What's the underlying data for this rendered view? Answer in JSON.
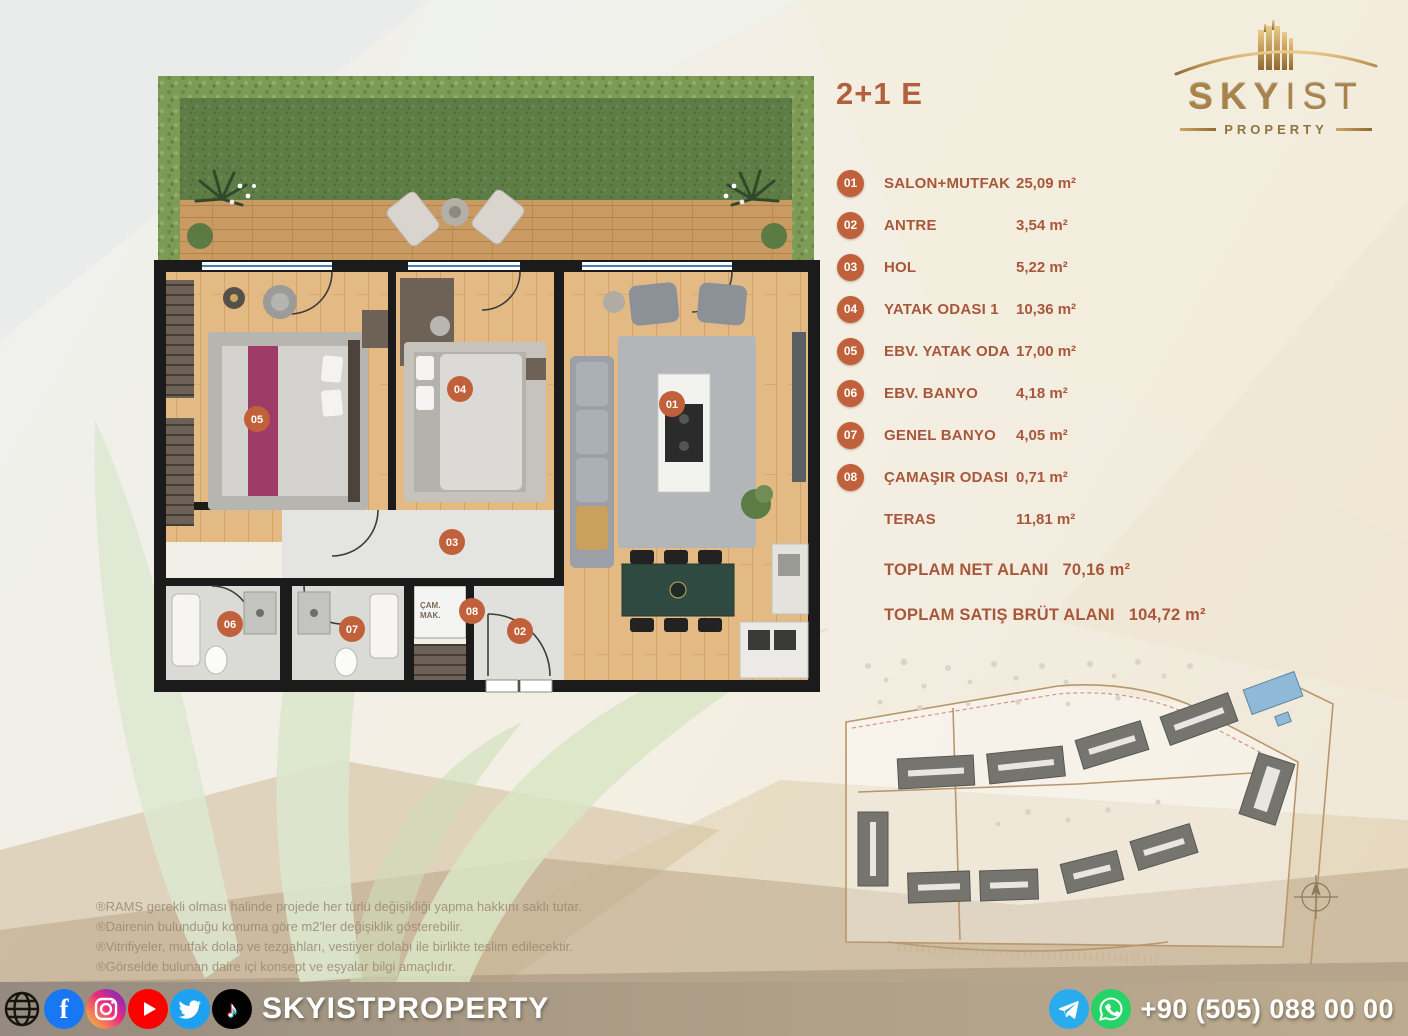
{
  "title": "2+1 E",
  "rooms": [
    {
      "num": "01",
      "label": "SALON+MUTFAK",
      "area": "25,09 m²"
    },
    {
      "num": "02",
      "label": "ANTRE",
      "area": "3,54 m²"
    },
    {
      "num": "03",
      "label": "HOL",
      "area": "5,22 m²"
    },
    {
      "num": "04",
      "label": "YATAK ODASI 1",
      "area": "10,36 m²"
    },
    {
      "num": "05",
      "label": "EBV. YATAK ODA",
      "area": "17,00 m²"
    },
    {
      "num": "06",
      "label": "EBV. BANYO",
      "area": "4,18 m²"
    },
    {
      "num": "07",
      "label": "GENEL BANYO",
      "area": "4,05 m²"
    },
    {
      "num": "08",
      "label": "ÇAMAŞIR ODASI",
      "area": "0,71 m²"
    },
    {
      "num": "",
      "label": "TERAS",
      "area": "11,81 m²"
    }
  ],
  "totals": {
    "net_label": "TOPLAM NET  ALANI",
    "net_value": "70,16 m²",
    "gross_label": "TOPLAM SATIŞ BRÜT  ALANI",
    "gross_value": "104,72 m²"
  },
  "logo": {
    "brand_bold": "SKY",
    "brand_light": "IST",
    "subtitle": "PROPERTY"
  },
  "floor_plan": {
    "washer_line1": "ÇAM.",
    "washer_line2": "MAK."
  },
  "disclaimers": [
    "®RAMS gerekli olması halinde projede her türlü değişikliği yapma hakkını saklı tutar.",
    "®Dairenin bulunduğu konuma göre m2'ler değişiklik gösterebilir.",
    "®Vitrifiyeler, mutfak dolap ve tezgahları, vestiyer dolabı ile birlikte teslim edilecektir.",
    "®Görselde bulunan daire içi konsept ve eşyalar bilgi amaçlıdır."
  ],
  "footer": {
    "brand": "SKYISTPROPERTY",
    "phone": "+90 (505) 088 00 00"
  },
  "glyphs": {
    "facebook": "f",
    "tiktok": "♪"
  },
  "icons": {
    "social": [
      "website",
      "facebook",
      "instagram",
      "youtube",
      "twitter",
      "tiktok"
    ],
    "contact": [
      "telegram",
      "whatsapp"
    ]
  },
  "colors": {
    "accent": "#A8573A",
    "badge": "#C1613C",
    "gold": "#A8834C",
    "leaf": "#DCE6CA",
    "facebook": "#1877F2",
    "youtube": "#FF0000",
    "twitter": "#1DA1F2",
    "telegram": "#2AABEE",
    "whatsapp": "#25D366",
    "highlight_building": "#8FB9D6"
  }
}
